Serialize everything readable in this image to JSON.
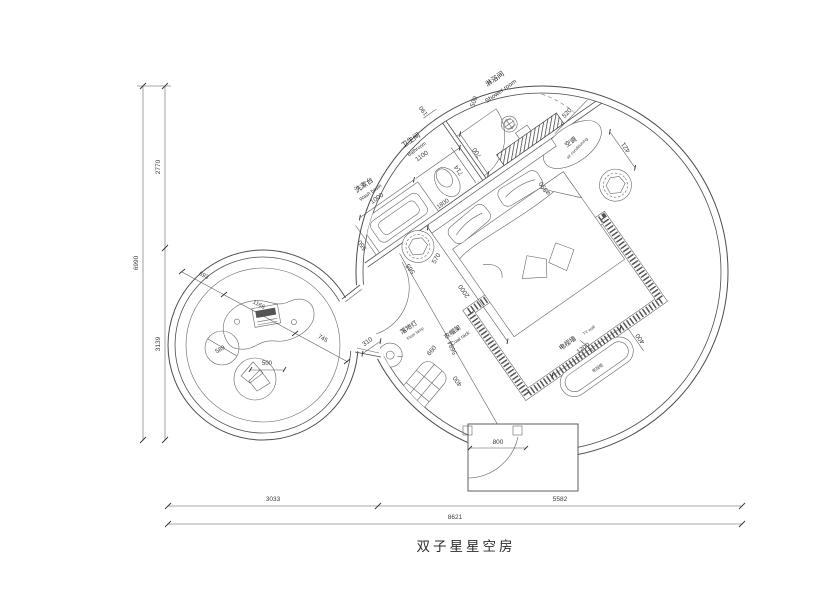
{
  "title": "双子星星空房",
  "labels": {
    "washbasin_zh": "洗漱台",
    "washbasin_en": "Wash basin",
    "bathroom_zh": "卫生间",
    "bathroom_en": "Bathroom",
    "shower_zh": "淋浴间",
    "shower_en": "Shower room",
    "ac_zh": "空调",
    "ac_en": "air conditioning",
    "lamp_zh": "落地灯",
    "lamp_en": "Floor lamp",
    "coat_zh": "衣帽架",
    "coat_en": "Coat rack",
    "tvwall_zh": "电视墙",
    "tvwall_en": "TV wall",
    "tv_cabinet": "电视柜"
  },
  "dims": {
    "total_width": "8621",
    "bottom_left": "3033",
    "bottom_right": "5582",
    "total_height": "6990",
    "height_upper": "2770",
    "height_lower": "3139",
    "entry_door": "800",
    "room_diagonal": "5684",
    "bed_length": "2000",
    "headwall": "1800",
    "basin_depth": "550",
    "basin_width": "1000",
    "bath_width": "1100",
    "wall_top": "190",
    "bath_door": "700",
    "shower_door": "500",
    "toilet_offset": "714",
    "stool_dia": "⌀590",
    "bedside_w": "565",
    "bedside_h": "570",
    "ac_w": "520",
    "ac_h": "421",
    "tv_w": "1200",
    "tv_d": "400",
    "coat_w": "660",
    "coat_d": "400",
    "lamp_dia": "310",
    "chain_1": "693",
    "chain_2": "1166",
    "chain_3": "745",
    "pouf": "589",
    "beanbag": "500"
  }
}
